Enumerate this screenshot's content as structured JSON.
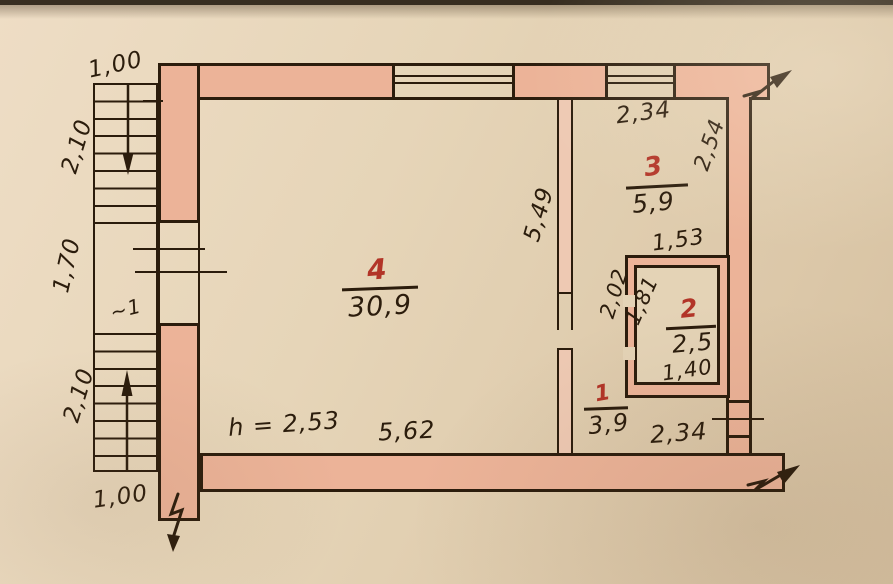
{
  "document": {
    "type": "hand-drawn apartment floor plan",
    "colors": {
      "wall_fill": "#ecb398",
      "paper": "#e4d3b6",
      "ink": "#2b1c0c",
      "room_number_red": "#b23427"
    }
  },
  "rooms": {
    "room1": {
      "number": "1",
      "area": "3,9"
    },
    "room2": {
      "number": "2",
      "area": "2,5"
    },
    "room3": {
      "number": "3",
      "area": "5,9"
    },
    "room4": {
      "number": "4",
      "area": "30,9"
    }
  },
  "dimensions": {
    "stair_width_top": "1,00",
    "stair_flight_top": "2,10",
    "stair_landing": "1,70",
    "stair_flight_bottom": "2,10",
    "stair_width_bottom": "1,00",
    "stair_mark": "~1",
    "partition_length": "5,49",
    "room3_width": "2,34",
    "room3_depth": "2,54",
    "room2_outer_width": "1,53",
    "room2_outer_depth": "2,02",
    "room2_inner_depth": "1,81",
    "room2_inner_width": "1,40",
    "bottom_right_width": "2,34",
    "room4_width": "5,62",
    "ceiling_height": "h = 2,53"
  }
}
